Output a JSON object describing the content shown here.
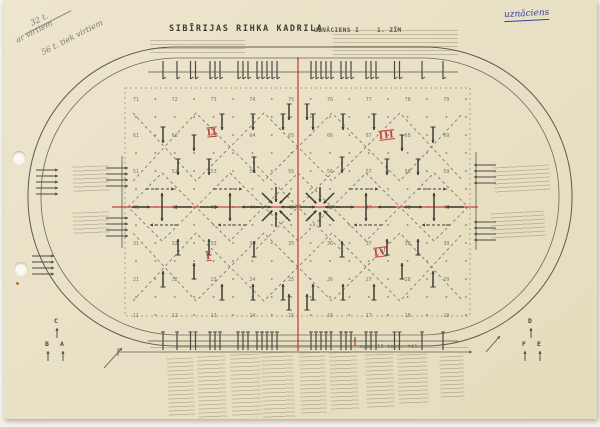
{
  "page": {
    "title": "SIBĪRIJAS RIHKA KADRILA",
    "subtitle": "UZNĀCIENS I",
    "figure_label": "1. ZĪM",
    "handwritten_blue_note": "uznāciens",
    "pencil_notes": [
      {
        "t": "32 t.",
        "x": 30,
        "y": 15
      },
      {
        "t": "ar virtiem",
        "x": 14,
        "y": 27
      },
      {
        "t": "56 t. tiek virtiem",
        "x": 38,
        "y": 33
      }
    ],
    "pencil_strike": {
      "x": 22,
      "y": 22
    },
    "measure_note": "apm. 10 kapt. tāl.",
    "quadrant_numerals": [
      {
        "t": "II",
        "x": 207,
        "y": 128
      },
      {
        "t": "III",
        "x": 379,
        "y": 131
      },
      {
        "t": "I",
        "x": 206,
        "y": 252
      },
      {
        "t": "IV",
        "x": 374,
        "y": 248
      }
    ],
    "corner_letters": [
      {
        "t": "C",
        "x": 54,
        "y": 317
      },
      {
        "t": "B",
        "x": 45,
        "y": 340
      },
      {
        "t": "A",
        "x": 60,
        "y": 340
      },
      {
        "t": "D",
        "x": 528,
        "y": 317
      },
      {
        "t": "F",
        "x": 522,
        "y": 340
      },
      {
        "t": "E",
        "x": 537,
        "y": 340
      }
    ]
  },
  "colors": {
    "paper": "#e9e1c6",
    "ink": "#4b4a40",
    "arrow": "#3e3d35",
    "dash": "#737264",
    "dot": "#70705f",
    "number": "#5c5b4e",
    "red": "#c2453a",
    "blue": "#31479c",
    "faint": "#9a927c"
  },
  "figure": {
    "stadium_outer": [
      28,
      47,
      544,
      299,
      148
    ],
    "stadium_inner": [
      41,
      58,
      518,
      277,
      137
    ],
    "field": [
      125,
      88,
      345,
      228
    ],
    "grid": {
      "x0": 136,
      "dx": 19.4,
      "cols": 18,
      "y0": 99,
      "dy": 18,
      "rows": 13,
      "row_labels": [
        7,
        6,
        5,
        4,
        3,
        2,
        1
      ]
    },
    "red_v": [
      298,
      57,
      351
    ],
    "red_h": [
      112,
      207,
      478
    ],
    "red_tick": [
      355,
      337,
      346
    ],
    "top_line": {
      "y": 72,
      "x1": 148,
      "x2": 458
    },
    "bottom_line": {
      "y": 341,
      "x1": 148,
      "x2": 458
    },
    "tick_groups": [
      {
        "x": 163,
        "n": 1
      },
      {
        "x": 177,
        "n": 1
      },
      {
        "x": 193,
        "n": 2
      },
      {
        "x": 215,
        "n": 3
      },
      {
        "x": 243,
        "n": 3
      },
      {
        "x": 267,
        "n": 5
      },
      {
        "x": 321,
        "n": 5
      },
      {
        "x": 346,
        "n": 3
      },
      {
        "x": 371,
        "n": 3
      },
      {
        "x": 397,
        "n": 2
      },
      {
        "x": 422,
        "n": 1
      },
      {
        "x": 443,
        "n": 1
      }
    ],
    "zigzags": [
      [
        [
          133,
          113
        ],
        [
          196,
          181
        ],
        [
          264,
          113
        ],
        [
          332,
          181
        ],
        [
          400,
          113
        ],
        [
          463,
          181
        ]
      ],
      [
        [
          133,
          181
        ],
        [
          196,
          113
        ],
        [
          264,
          181
        ],
        [
          332,
          113
        ],
        [
          400,
          181
        ],
        [
          463,
          113
        ]
      ],
      [
        [
          133,
          233
        ],
        [
          196,
          301
        ],
        [
          264,
          233
        ],
        [
          332,
          301
        ],
        [
          400,
          233
        ],
        [
          463,
          301
        ]
      ],
      [
        [
          133,
          301
        ],
        [
          196,
          233
        ],
        [
          264,
          301
        ],
        [
          332,
          233
        ],
        [
          400,
          301
        ],
        [
          463,
          233
        ]
      ]
    ],
    "diamonds": [
      162,
      230,
      298,
      366,
      434
    ],
    "diamond_r": 34,
    "center_x": [
      [
        253,
        162,
        343,
        252
      ],
      [
        343,
        162,
        253,
        252
      ]
    ],
    "stations": [
      162,
      230,
      366,
      434
    ],
    "stars": [
      [
        276,
        207
      ],
      [
        320,
        207
      ]
    ],
    "v_arrows": [
      [
        289,
        112,
        "d"
      ],
      [
        307,
        112,
        "d"
      ],
      [
        222,
        122,
        "d"
      ],
      [
        253,
        122,
        "d"
      ],
      [
        283,
        122,
        "d"
      ],
      [
        313,
        122,
        "d"
      ],
      [
        343,
        122,
        "d"
      ],
      [
        374,
        122,
        "d"
      ],
      [
        163,
        135,
        "d"
      ],
      [
        433,
        135,
        "d"
      ],
      [
        194,
        143,
        "d"
      ],
      [
        402,
        143,
        "d"
      ],
      [
        178,
        167,
        "d"
      ],
      [
        209,
        167,
        "d"
      ],
      [
        254,
        165,
        "d"
      ],
      [
        342,
        165,
        "d"
      ],
      [
        387,
        167,
        "d"
      ],
      [
        418,
        167,
        "d"
      ],
      [
        178,
        247,
        "u"
      ],
      [
        209,
        247,
        "u"
      ],
      [
        254,
        249,
        "u"
      ],
      [
        342,
        249,
        "u"
      ],
      [
        387,
        247,
        "u"
      ],
      [
        418,
        247,
        "u"
      ],
      [
        194,
        271,
        "u"
      ],
      [
        402,
        271,
        "u"
      ],
      [
        163,
        279,
        "u"
      ],
      [
        433,
        279,
        "u"
      ],
      [
        222,
        292,
        "u"
      ],
      [
        253,
        292,
        "u"
      ],
      [
        283,
        292,
        "u"
      ],
      [
        313,
        292,
        "u"
      ],
      [
        343,
        292,
        "u"
      ],
      [
        374,
        292,
        "u"
      ],
      [
        289,
        302,
        "u"
      ],
      [
        307,
        302,
        "u"
      ]
    ],
    "stacks": {
      "left_outer": [
        {
          "x": 36,
          "y": 170,
          "n": 5
        },
        {
          "x": 32,
          "y": 256,
          "n": 4
        }
      ],
      "left_inner": {
        "line": [
          122,
          156,
          248
        ],
        "bars": [
          {
            "x": 106,
            "y": 168,
            "n": 4
          },
          {
            "x": 106,
            "y": 218,
            "n": 4
          }
        ]
      },
      "right_inner": {
        "line": [
          476,
          152,
          250
        ],
        "bars": [
          {
            "x": 474,
            "y": 165,
            "n": 4
          },
          {
            "x": 474,
            "y": 222,
            "n": 4
          }
        ]
      }
    },
    "measure": {
      "x1": 118,
      "x2": 472,
      "y": 352
    },
    "diag_arrows": [
      [
        104,
        368,
        122,
        348
      ],
      [
        486,
        352,
        500,
        336
      ]
    ],
    "letter_arrow_dy": [
      11,
      21
    ],
    "text_blocks": [
      [
        150,
        40,
        95,
        13,
        0
      ],
      [
        333,
        30,
        125,
        25,
        0
      ],
      [
        73,
        166,
        36,
        28,
        -2
      ],
      [
        73,
        212,
        36,
        24,
        -2
      ],
      [
        494,
        166,
        56,
        28,
        -3
      ],
      [
        491,
        212,
        54,
        26,
        -3
      ],
      [
        168,
        358,
        26,
        58,
        -2
      ],
      [
        198,
        356,
        28,
        62,
        -2
      ],
      [
        231,
        354,
        30,
        64,
        -2
      ],
      [
        262,
        352,
        32,
        66,
        -2
      ],
      [
        300,
        352,
        26,
        62,
        -2
      ],
      [
        330,
        352,
        28,
        58,
        -2
      ],
      [
        366,
        354,
        28,
        56,
        -2
      ],
      [
        398,
        354,
        30,
        52,
        -2
      ],
      [
        440,
        356,
        24,
        44,
        -2
      ],
      [
        150,
        347,
        318,
        4,
        0
      ]
    ]
  }
}
